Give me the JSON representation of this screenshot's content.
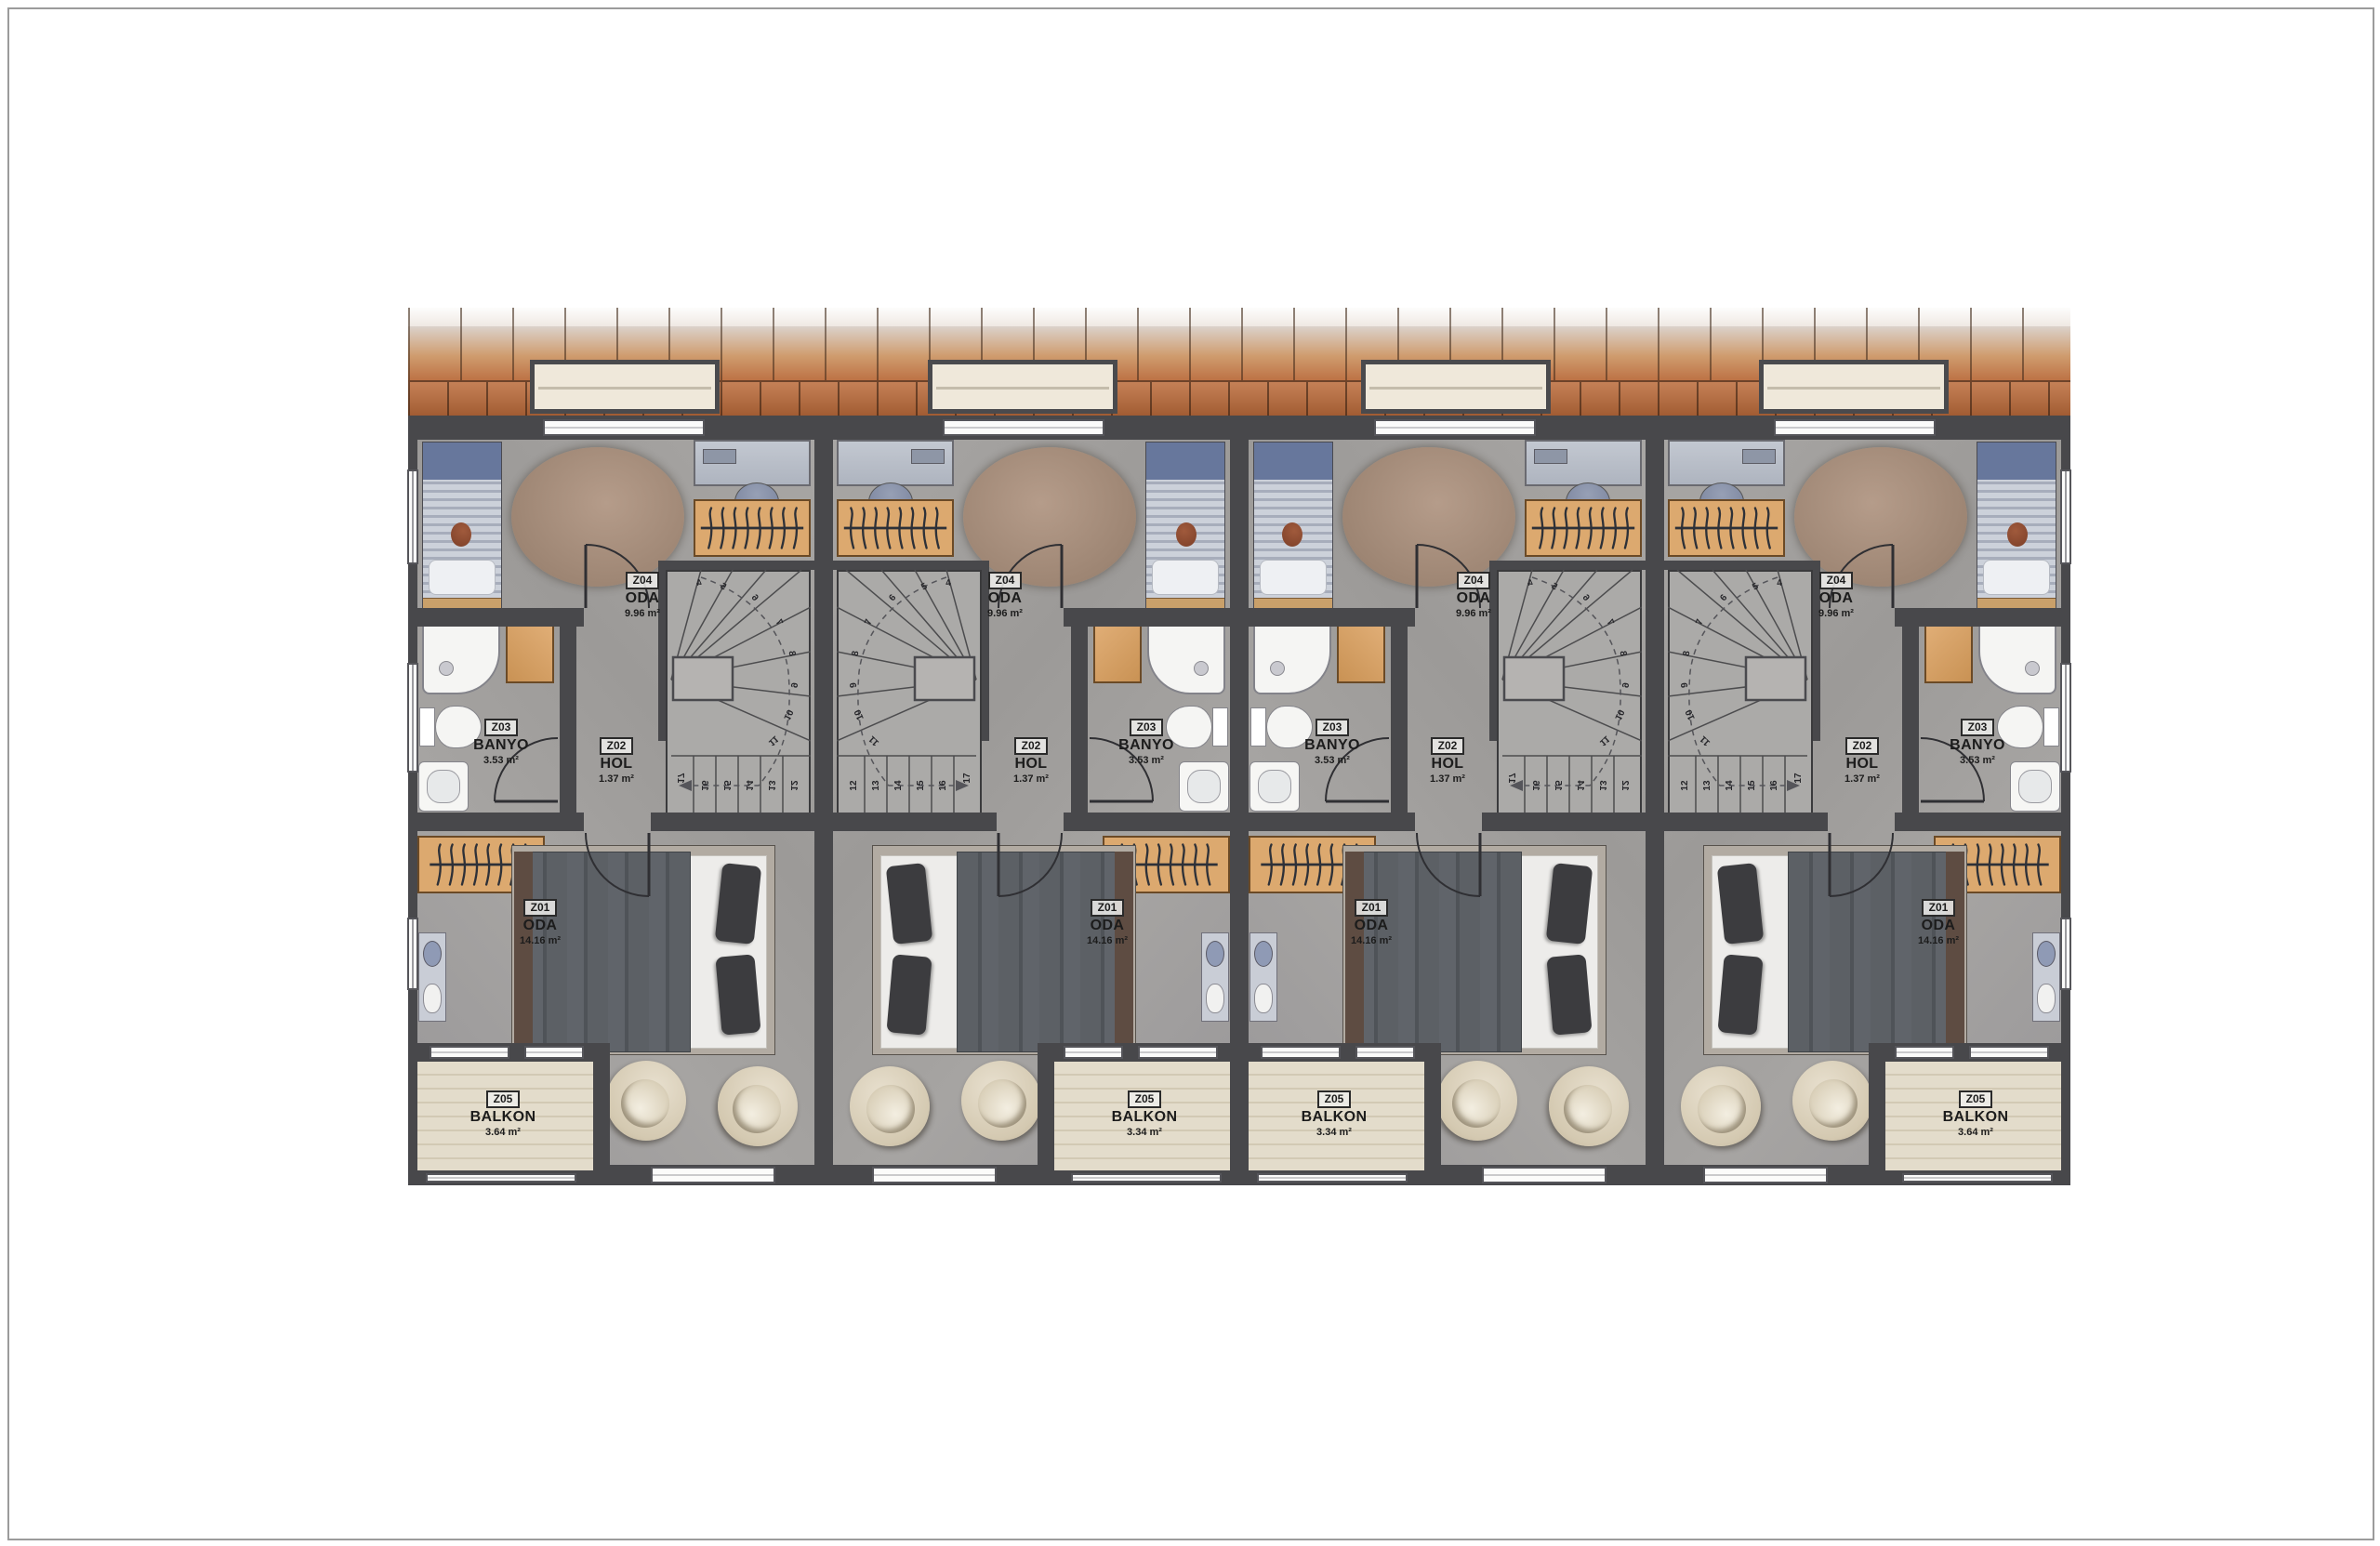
{
  "plan": {
    "type": "architectural-floor-plan",
    "stair_steps": [
      "4",
      "5",
      "6",
      "7",
      "8",
      "9",
      "10",
      "11",
      "12",
      "13",
      "14",
      "15",
      "16",
      "17"
    ],
    "units": [
      {
        "id": "unit-1",
        "mirrored": true,
        "end_unit": true,
        "rooms": {
          "z01": {
            "code": "Z01",
            "name": "ODA",
            "area": "14.16 m²"
          },
          "z02": {
            "code": "Z02",
            "name": "HOL",
            "area": "1.37 m²"
          },
          "z03": {
            "code": "Z03",
            "name": "BANYO",
            "area": "3.53 m²"
          },
          "z04": {
            "code": "Z04",
            "name": "ODA",
            "area": "9.96 m²"
          },
          "z05": {
            "code": "Z05",
            "name": "BALKON",
            "area": "3.64 m²"
          }
        }
      },
      {
        "id": "unit-2",
        "mirrored": false,
        "end_unit": false,
        "rooms": {
          "z01": {
            "code": "Z01",
            "name": "ODA",
            "area": "14.16 m²"
          },
          "z02": {
            "code": "Z02",
            "name": "HOL",
            "area": "1.37 m²"
          },
          "z03": {
            "code": "Z03",
            "name": "BANYO",
            "area": "3.53 m²"
          },
          "z04": {
            "code": "Z04",
            "name": "ODA",
            "area": "9.96 m²"
          },
          "z05": {
            "code": "Z05",
            "name": "BALKON",
            "area": "3.34 m²"
          }
        }
      },
      {
        "id": "unit-3",
        "mirrored": true,
        "end_unit": false,
        "rooms": {
          "z01": {
            "code": "Z01",
            "name": "ODA",
            "area": "14.16 m²"
          },
          "z02": {
            "code": "Z02",
            "name": "HOL",
            "area": "1.37 m²"
          },
          "z03": {
            "code": "Z03",
            "name": "BANYO",
            "area": "3.53 m²"
          },
          "z04": {
            "code": "Z04",
            "name": "ODA",
            "area": "9.96 m²"
          },
          "z05": {
            "code": "Z05",
            "name": "BALKON",
            "area": "3.34 m²"
          }
        }
      },
      {
        "id": "unit-4",
        "mirrored": false,
        "end_unit": true,
        "rooms": {
          "z01": {
            "code": "Z01",
            "name": "ODA",
            "area": "14.16 m²"
          },
          "z02": {
            "code": "Z02",
            "name": "HOL",
            "area": "1.37 m²"
          },
          "z03": {
            "code": "Z03",
            "name": "BANYO",
            "area": "3.53 m²"
          },
          "z04": {
            "code": "Z04",
            "name": "ODA",
            "area": "9.96 m²"
          },
          "z05": {
            "code": "Z05",
            "name": "BALKON",
            "area": "3.64 m²"
          }
        }
      }
    ],
    "furniture_items": [
      "single-bed",
      "double-bed",
      "oval-rug",
      "desk",
      "desk-chair",
      "wardrobe",
      "shower",
      "bathroom-cabinet",
      "toilet",
      "sink",
      "vanity",
      "armchair",
      "winder-staircase",
      "dormer-window",
      "balcony"
    ],
    "colors": {
      "roof_tile_dark": "#a25c33",
      "roof_tile_light": "#dbd2cb",
      "wall": "#48484b",
      "room_floor": "#a3a19f",
      "balcony_wood": "#ded6c5",
      "furniture_wood": "#d9a76e",
      "rug": "#a68d7c",
      "bed_blue": "#67779c",
      "fixture_white": "#f5f5f3",
      "label_text": "#1c1c1c"
    }
  }
}
